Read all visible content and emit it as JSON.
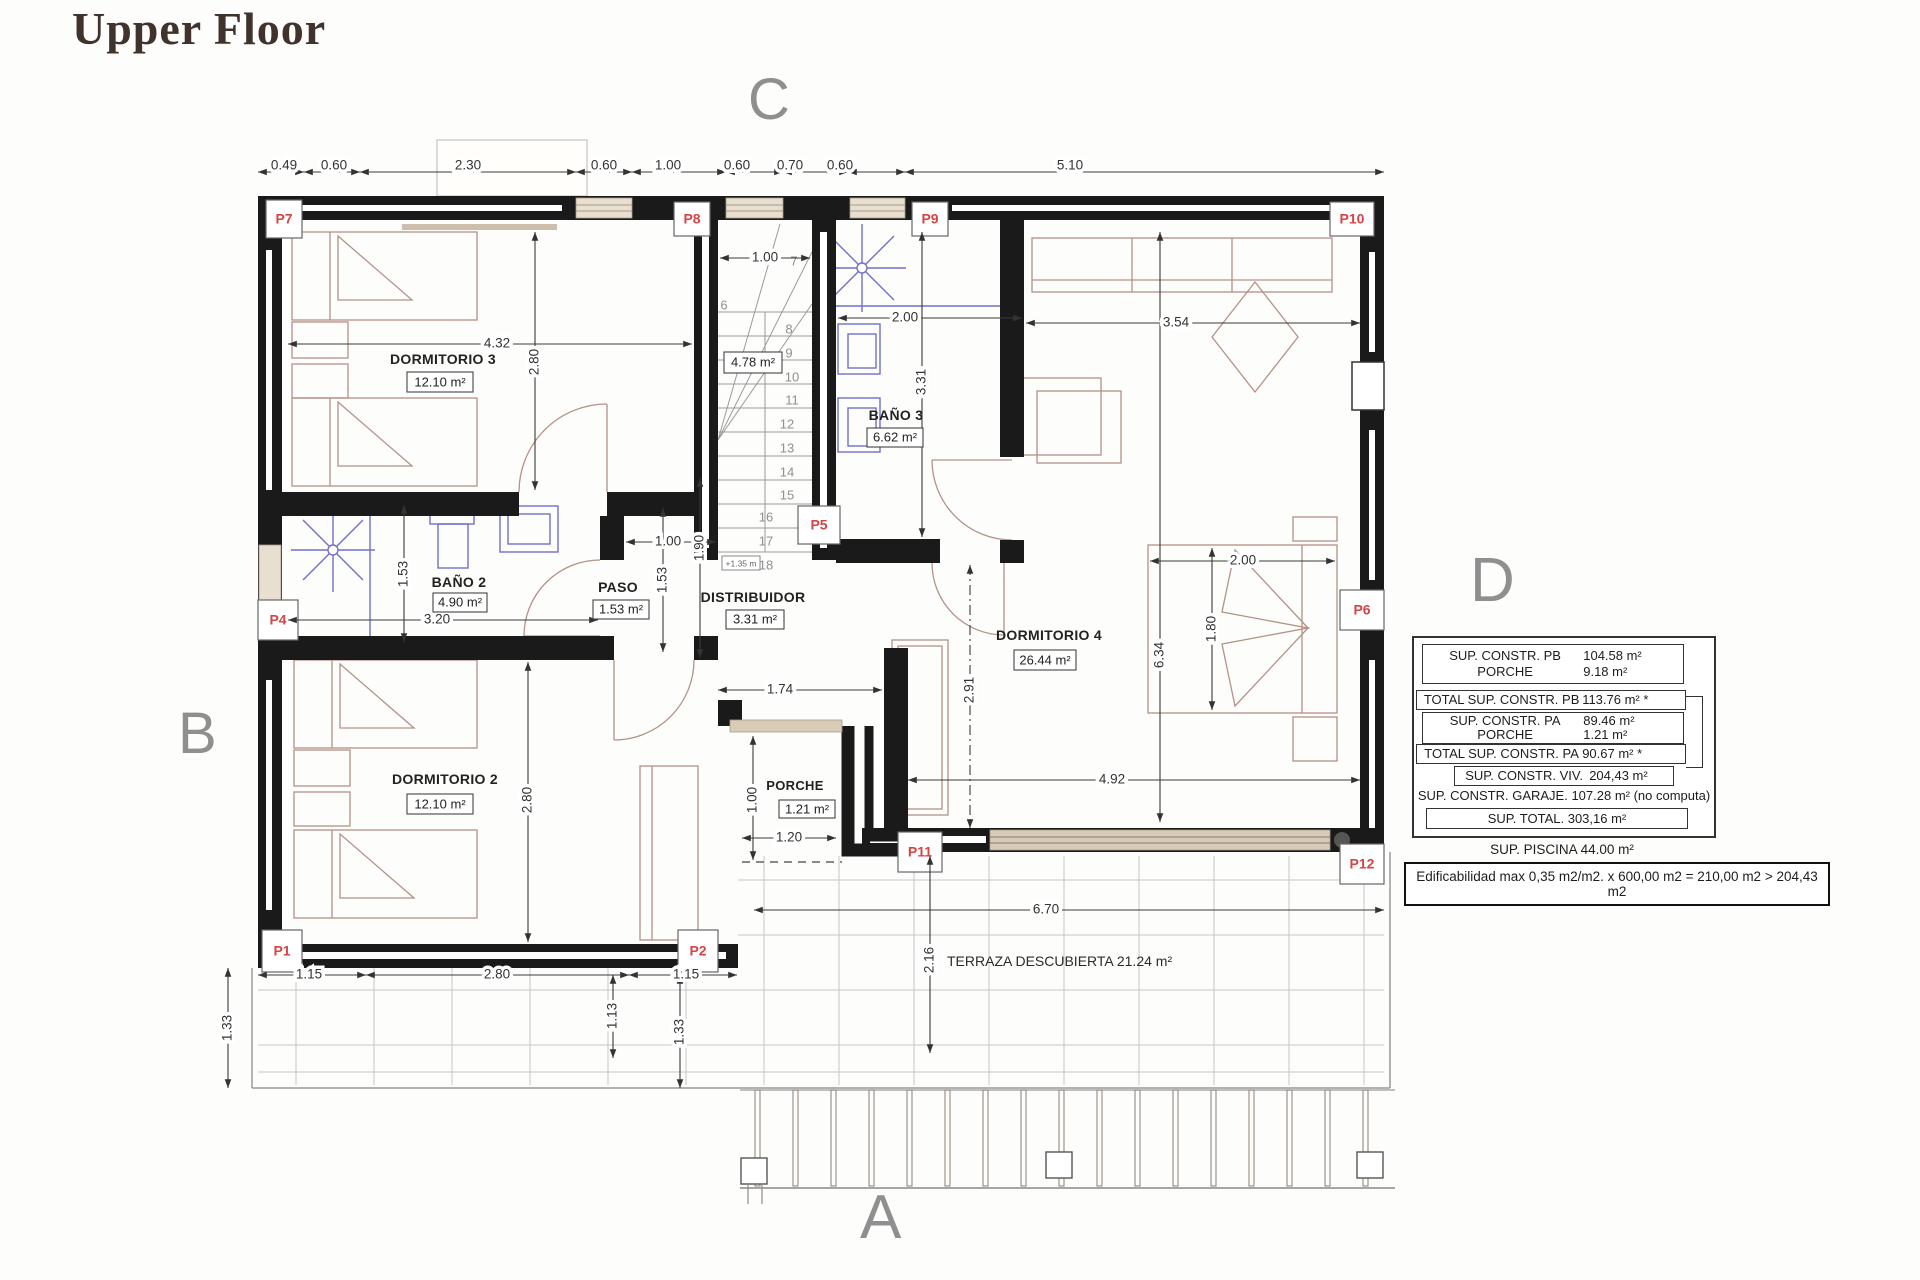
{
  "title": "Upper Floor",
  "compass": {
    "top": "C",
    "bottom": "A",
    "left": "B",
    "right": "D"
  },
  "colors": {
    "wall": "#1a1a1a",
    "furniture": "#b59186",
    "fixture": "#7070cd",
    "door_label_red": "#d64545",
    "letter_gray": "#8f8f8f"
  },
  "rooms": {
    "d3": {
      "name": "DORMITORIO 3",
      "area": "12.10 m²"
    },
    "d2": {
      "name": "DORMITORIO 2",
      "area": "12.10 m²"
    },
    "d4": {
      "name": "DORMITORIO 4",
      "area": "26.44 m²"
    },
    "b2": {
      "name": "BAÑO 2",
      "area": "4.90 m²"
    },
    "b3": {
      "name": "BAÑO 3",
      "area": "6.62 m²"
    },
    "paso": {
      "name": "PASO",
      "area": "1.53 m²"
    },
    "dist": {
      "name": "DISTRIBUIDOR",
      "area": "3.31 m²"
    },
    "porche": {
      "name": "PORCHE",
      "area": "1.21 m²"
    },
    "terraza": {
      "name": "TERRAZA DESCUBIERTA 21.24 m²"
    },
    "stair_area": "4.78 m²",
    "stair_level": "+1.35 m"
  },
  "doors": {
    "p1": "P1",
    "p2": "P2",
    "p4": "P4",
    "p5": "P5",
    "p6": "P6",
    "p7": "P7",
    "p8": "P8",
    "p9": "P9",
    "p10": "P10",
    "p11": "P11",
    "p12": "P12"
  },
  "stairs": [
    "6",
    "7",
    "8",
    "9",
    "10",
    "11",
    "12",
    "13",
    "14",
    "15",
    "16",
    "17",
    "18"
  ],
  "dims": {
    "top": [
      "0.49",
      "0.60",
      "2.30",
      "0.60",
      "1.00",
      "0.60",
      "0.70",
      "0.60",
      "5.10"
    ],
    "bottom": [
      "1.15",
      "2.80",
      "1.15"
    ],
    "d3_w": "4.32",
    "d3_h": "2.80",
    "d2_h": "2.80",
    "b2_h": "1.53",
    "b2_w": "3.20",
    "paso_w": "1.00",
    "paso_h": "1.53",
    "pass_h": "1.90",
    "stair_w": "1.00",
    "b3_w": "2.00",
    "b3_h": "3.31",
    "d4_top": "3.54",
    "d4_h": "6.34",
    "d4_entry": "2.91",
    "d4_w": "4.92",
    "bed_w": "2.00",
    "bed_h": "1.80",
    "dist_w": "1.74",
    "porche_h": "1.00",
    "porche_w": "1.20",
    "terr_w": "6.70",
    "terr_h": "2.16",
    "out_l": "1.33",
    "out_b1": "1.13",
    "out_b2": "1.33"
  },
  "table": {
    "rows": [
      {
        "label": "SUP. CONSTR. PB",
        "value": "104.58 m²"
      },
      {
        "label": "PORCHE",
        "value": "9.18 m²"
      },
      {
        "label": "TOTAL SUP. CONSTR. PB",
        "value": "113.76 m² *"
      },
      {
        "label": "SUP. CONSTR. PA",
        "value": "89.46 m²"
      },
      {
        "label": "PORCHE",
        "value": "1.21 m²"
      },
      {
        "label": "TOTAL SUP. CONSTR. PA",
        "value": "90.67 m² *"
      },
      {
        "label": "SUP. CONSTR. VIV.",
        "value": "204,43 m²"
      },
      {
        "label": "SUP. CONSTR. GARAJE.",
        "value": "107.28 m² (no computa)"
      },
      {
        "label": "SUP. TOTAL.",
        "value": "303,16 m²"
      }
    ],
    "piscina": "SUP. PISCINA 44.00 m²",
    "note": "Edificabilidad max 0,35 m2/m2. x 600,00 m2 = 210,00 m2 > 204,43 m2"
  }
}
